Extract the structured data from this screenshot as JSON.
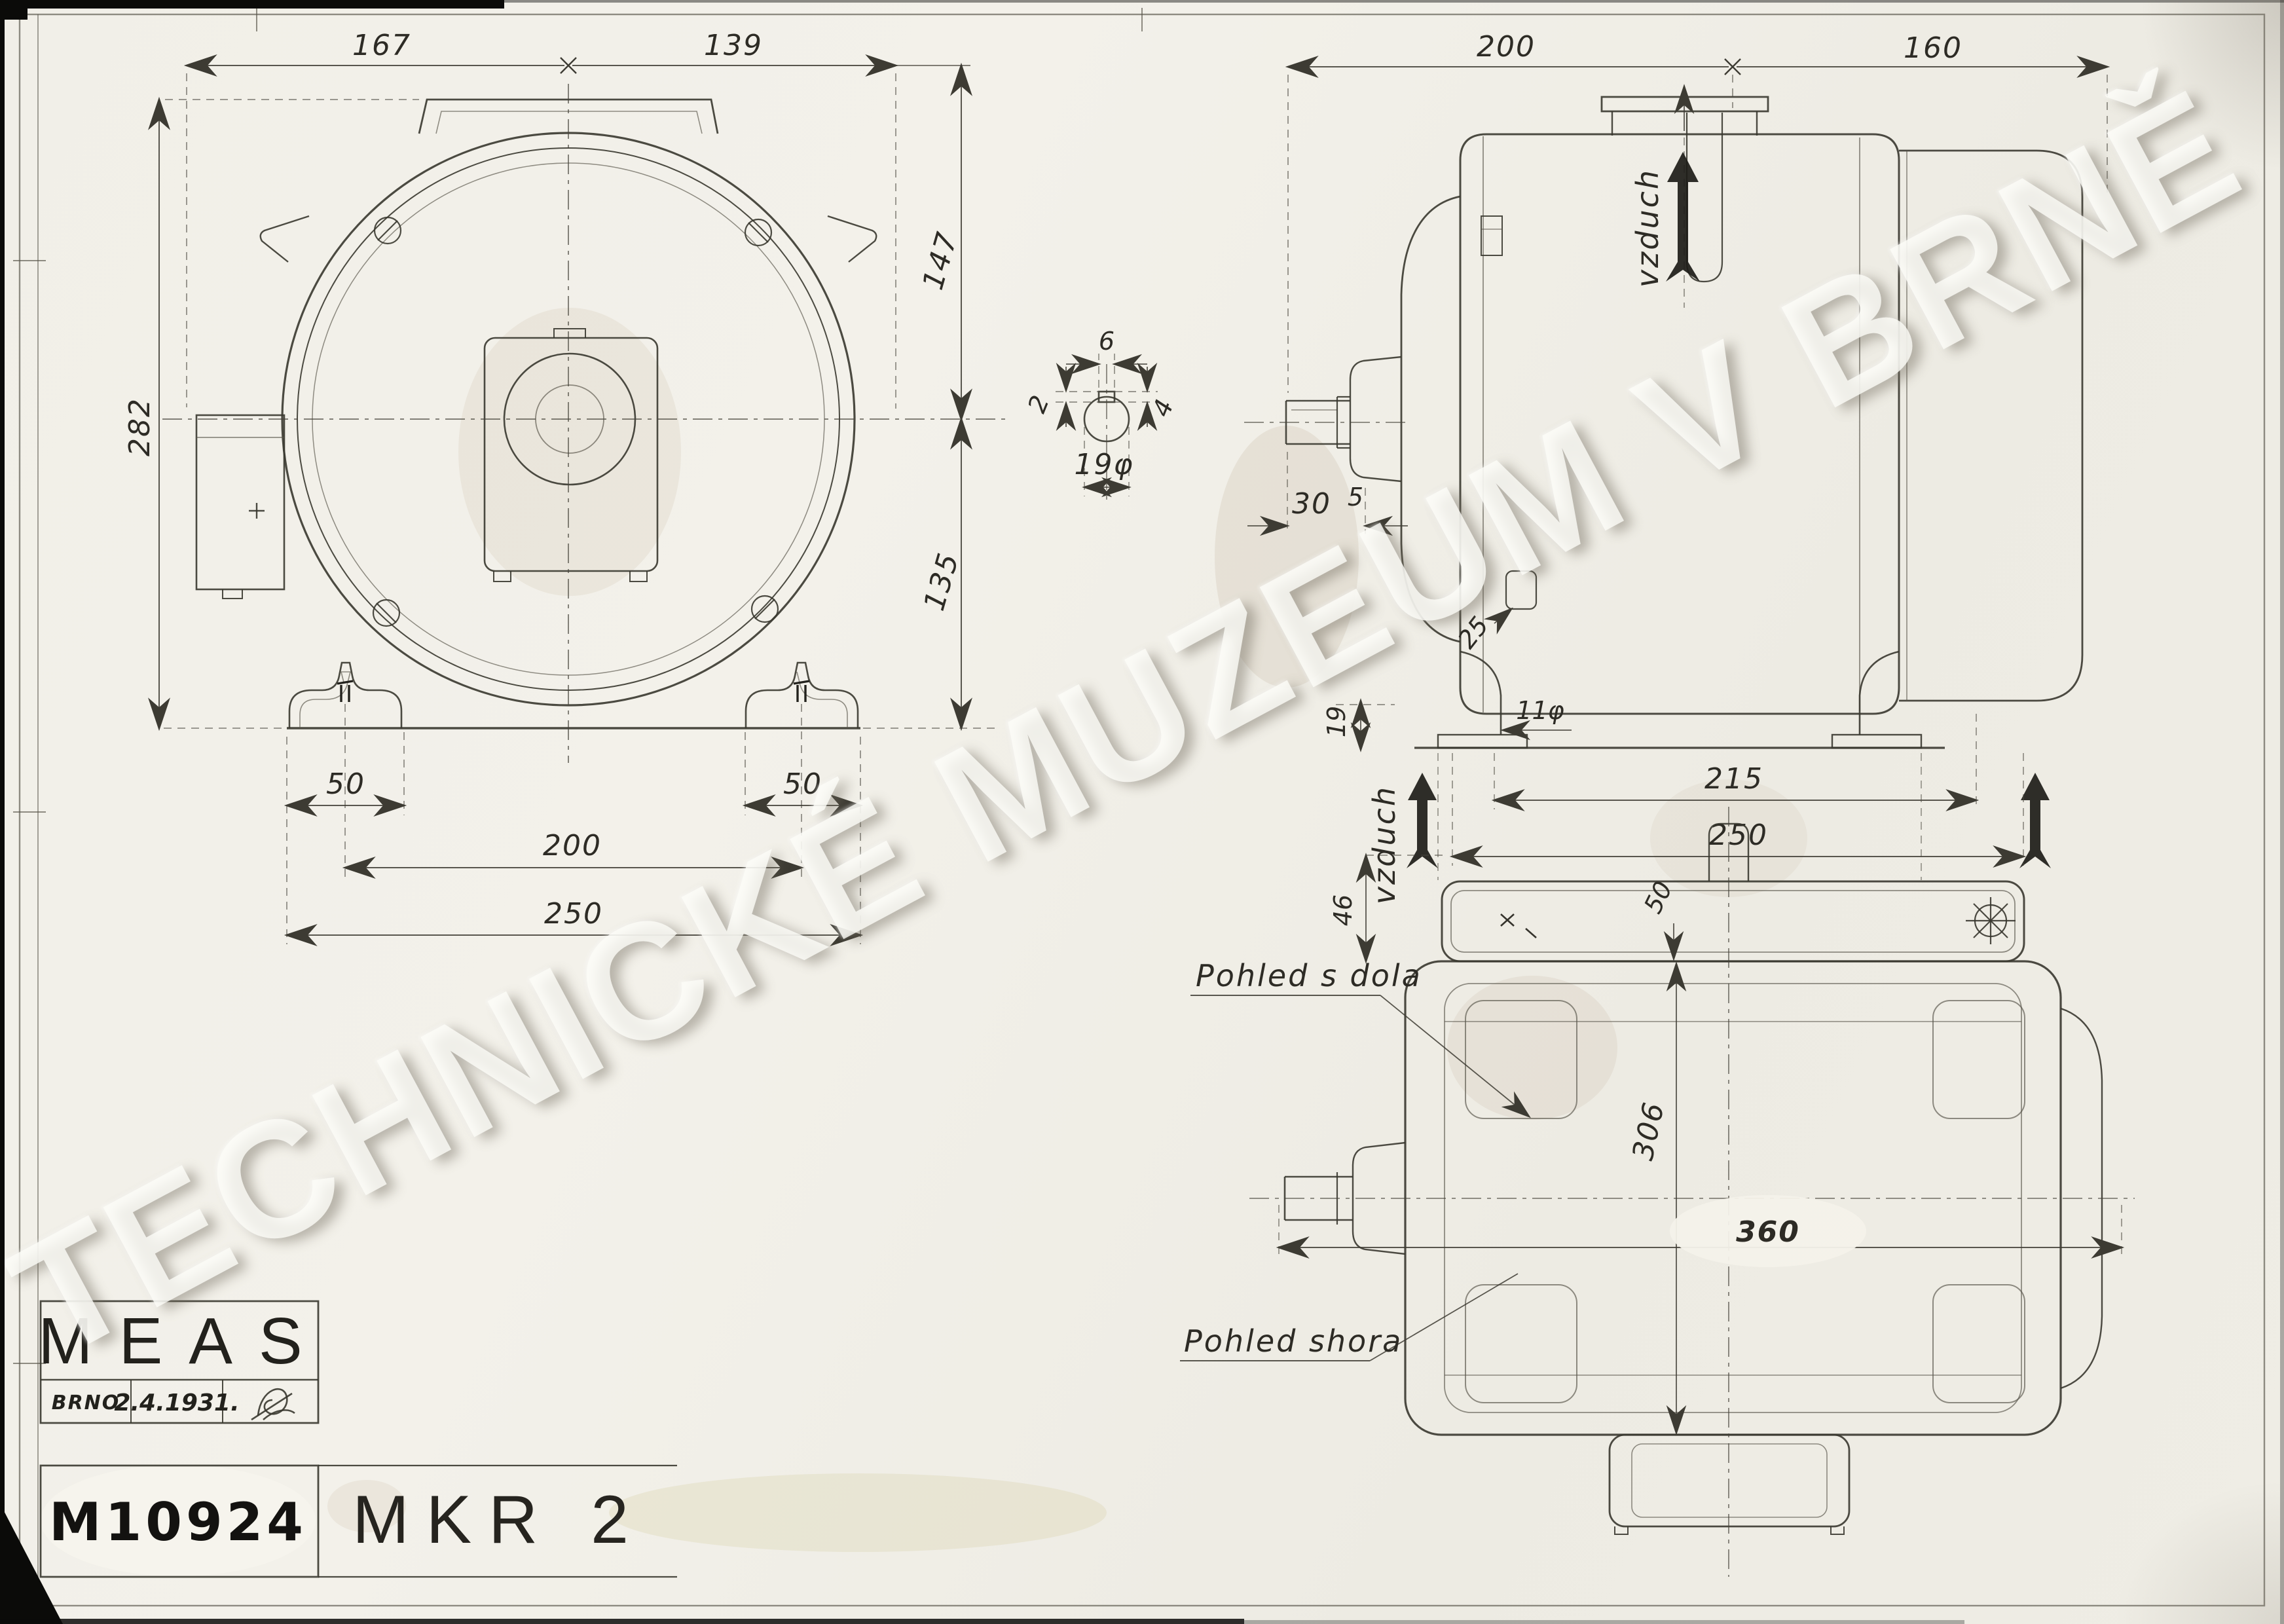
{
  "watermark_text": "TECHNICKÉ MUZEUM V BRNĚ",
  "title_block": {
    "company": "MEAS",
    "city": "BRNO",
    "date": "2.4.1931.",
    "drawing_number": "M10924",
    "model": "MKR 2"
  },
  "front_view": {
    "dim_top_left": "167",
    "dim_top_right": "139",
    "dim_height": "282",
    "dim_center_to_top": "147",
    "dim_center_to_base": "135",
    "dim_foot_left": "50",
    "dim_foot_right": "50",
    "dim_bolt_span": "200",
    "dim_base_width": "250"
  },
  "shaft_detail": {
    "dim_key_width": "6",
    "dim_key_top": "2",
    "dim_key_depth": "4",
    "dim_shaft_diameter": "19φ"
  },
  "side_view": {
    "dim_body_length": "200",
    "dim_fan_length": "160",
    "dim_shaft_extension": "30",
    "dim_shoulder_gap": "5",
    "dim_slot": "25",
    "dim_foot_height": "19",
    "dim_foot_hole": "11φ",
    "dim_foot_span": "215",
    "dim_overall_length": "250",
    "air_label_top": "vzduch",
    "air_label_bottom": "vzduch"
  },
  "top_view": {
    "label_bottom_view": "Pohled s dola",
    "label_top_view": "Pohled shora",
    "dim_foot_plate": "46",
    "dim_foot_depth": "50",
    "dim_body_length": "306",
    "dim_overall_width": "360"
  }
}
